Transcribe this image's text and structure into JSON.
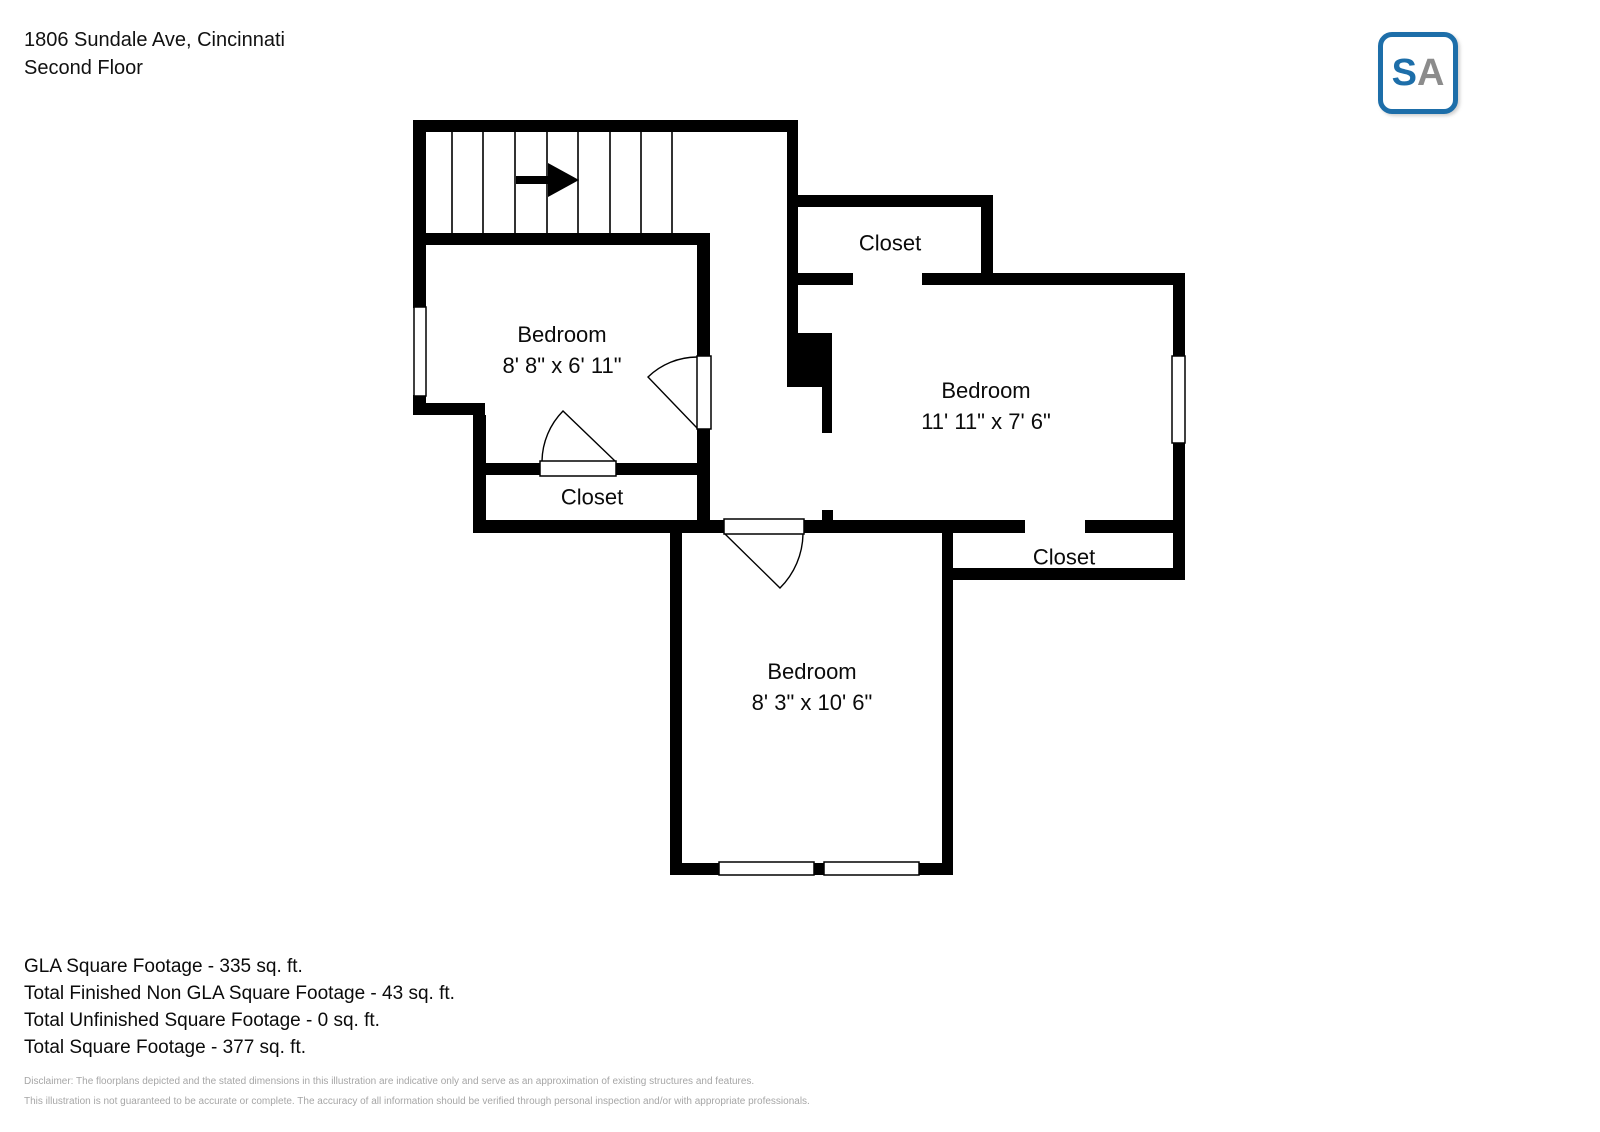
{
  "header": {
    "address": "1806 Sundale Ave, Cincinnati",
    "floor": "Second Floor"
  },
  "logo": {
    "letter_s": "S",
    "letter_a": "A",
    "border_color": "#1d6ea9",
    "s_color": "#1d6ea9",
    "a_color": "#8c8c8c"
  },
  "plan": {
    "wall_color": "#000000",
    "stairs_direction": "right"
  },
  "rooms": {
    "bedroom_left": {
      "name": "Bedroom",
      "dims": "8' 8\" x 6' 11\""
    },
    "bedroom_right": {
      "name": "Bedroom",
      "dims": "11' 11\" x 7' 6\""
    },
    "bedroom_bottom": {
      "name": "Bedroom",
      "dims": "8' 3\" x 10' 6\""
    },
    "closet_top": {
      "name": "Closet"
    },
    "closet_left": {
      "name": "Closet"
    },
    "closet_right": {
      "name": "Closet"
    }
  },
  "footer": {
    "lines": [
      "GLA Square Footage - 335 sq. ft.",
      "Total Finished Non GLA Square Footage - 43 sq. ft.",
      "Total Unfinished Square Footage - 0 sq. ft.",
      "Total Square Footage - 377 sq. ft."
    ],
    "disclaimer": [
      "Disclaimer: The floorplans depicted and the stated dimensions in this illustration are indicative only and serve as an approximation of existing structures and features.",
      "This illustration is not guaranteed to be accurate or complete. The accuracy of all information should be verified through personal inspection and/or with appropriate professionals."
    ]
  }
}
